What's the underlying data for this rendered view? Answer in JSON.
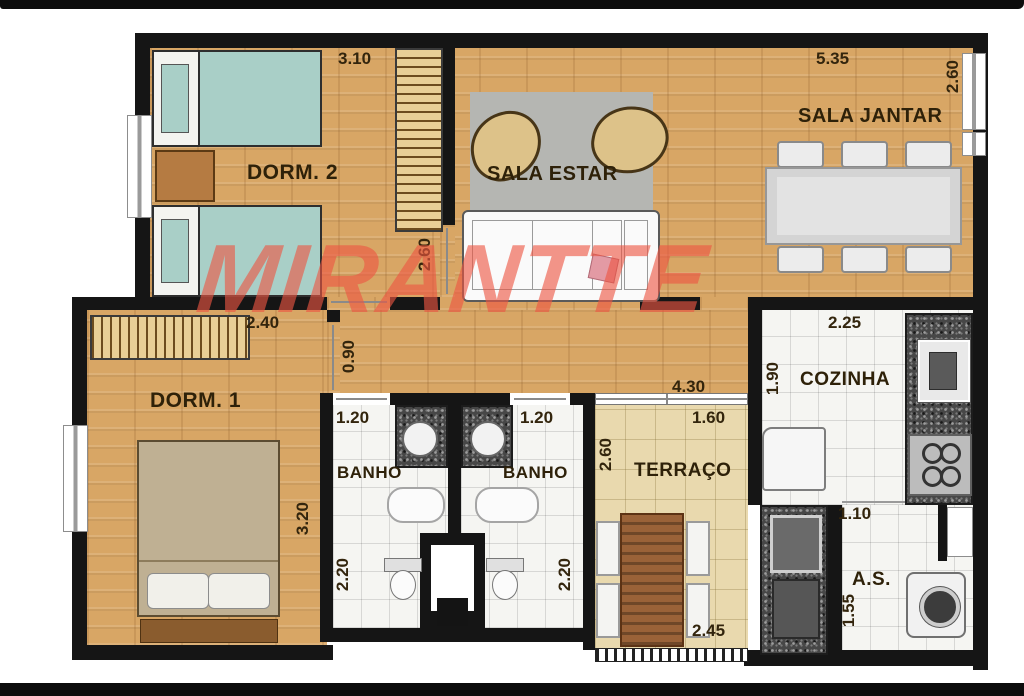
{
  "title": "Planta do apartamento",
  "watermark": {
    "text": "MIRANTTE",
    "color": "#ee5642"
  },
  "rooms": {
    "dorm2": {
      "label": "DORM. 2"
    },
    "sala_estar": {
      "label": "SALA ESTAR"
    },
    "sala_jantar": {
      "label": "SALA JANTAR"
    },
    "dorm1": {
      "label": "DORM. 1"
    },
    "banho1": {
      "label": "BANHO"
    },
    "banho2": {
      "label": "BANHO"
    },
    "terraco": {
      "label": "TERRAÇO"
    },
    "cozinha": {
      "label": "COZINHA"
    },
    "servico": {
      "label": "A.S."
    }
  },
  "dimensions": [
    {
      "id": "dorm2-top",
      "value": "3.10",
      "orientation": "h"
    },
    {
      "id": "jantar-top",
      "value": "5.35",
      "orientation": "h"
    },
    {
      "id": "jantar-right",
      "value": "2.60",
      "orientation": "v"
    },
    {
      "id": "dorm2-door",
      "value": "2.60",
      "orientation": "v"
    },
    {
      "id": "dorm1-top",
      "value": "2.40",
      "orientation": "h"
    },
    {
      "id": "hall-opening",
      "value": "0.90",
      "orientation": "v"
    },
    {
      "id": "hall-width",
      "value": "4.30",
      "orientation": "h"
    },
    {
      "id": "cozinha-left",
      "value": "1.90",
      "orientation": "v"
    },
    {
      "id": "cozinha-top",
      "value": "2.25",
      "orientation": "h"
    },
    {
      "id": "banho1-top",
      "value": "1.20",
      "orientation": "h"
    },
    {
      "id": "banho2-top",
      "value": "1.20",
      "orientation": "h"
    },
    {
      "id": "terraco-top",
      "value": "1.60",
      "orientation": "h"
    },
    {
      "id": "terraco-left",
      "value": "2.60",
      "orientation": "v"
    },
    {
      "id": "dorm1-right",
      "value": "3.20",
      "orientation": "v"
    },
    {
      "id": "banho1-left",
      "value": "2.20",
      "orientation": "v"
    },
    {
      "id": "banho2-left",
      "value": "2.20",
      "orientation": "v"
    },
    {
      "id": "terraco-bottom",
      "value": "2.45",
      "orientation": "h"
    },
    {
      "id": "servico-top",
      "value": "1.10",
      "orientation": "h"
    },
    {
      "id": "servico-left",
      "value": "1.55",
      "orientation": "v"
    }
  ],
  "colors": {
    "wall": "#151515",
    "wood_floor": "#d8a665",
    "terrace_floor": "#e9d9ae",
    "tile_floor": "#f5f5f2",
    "granite": "#474747",
    "bed_teal": "#a9cfc7",
    "bed_tan": "#bfb093",
    "rug_gray": "#b5b6b2",
    "label_text": "#2e2109"
  }
}
